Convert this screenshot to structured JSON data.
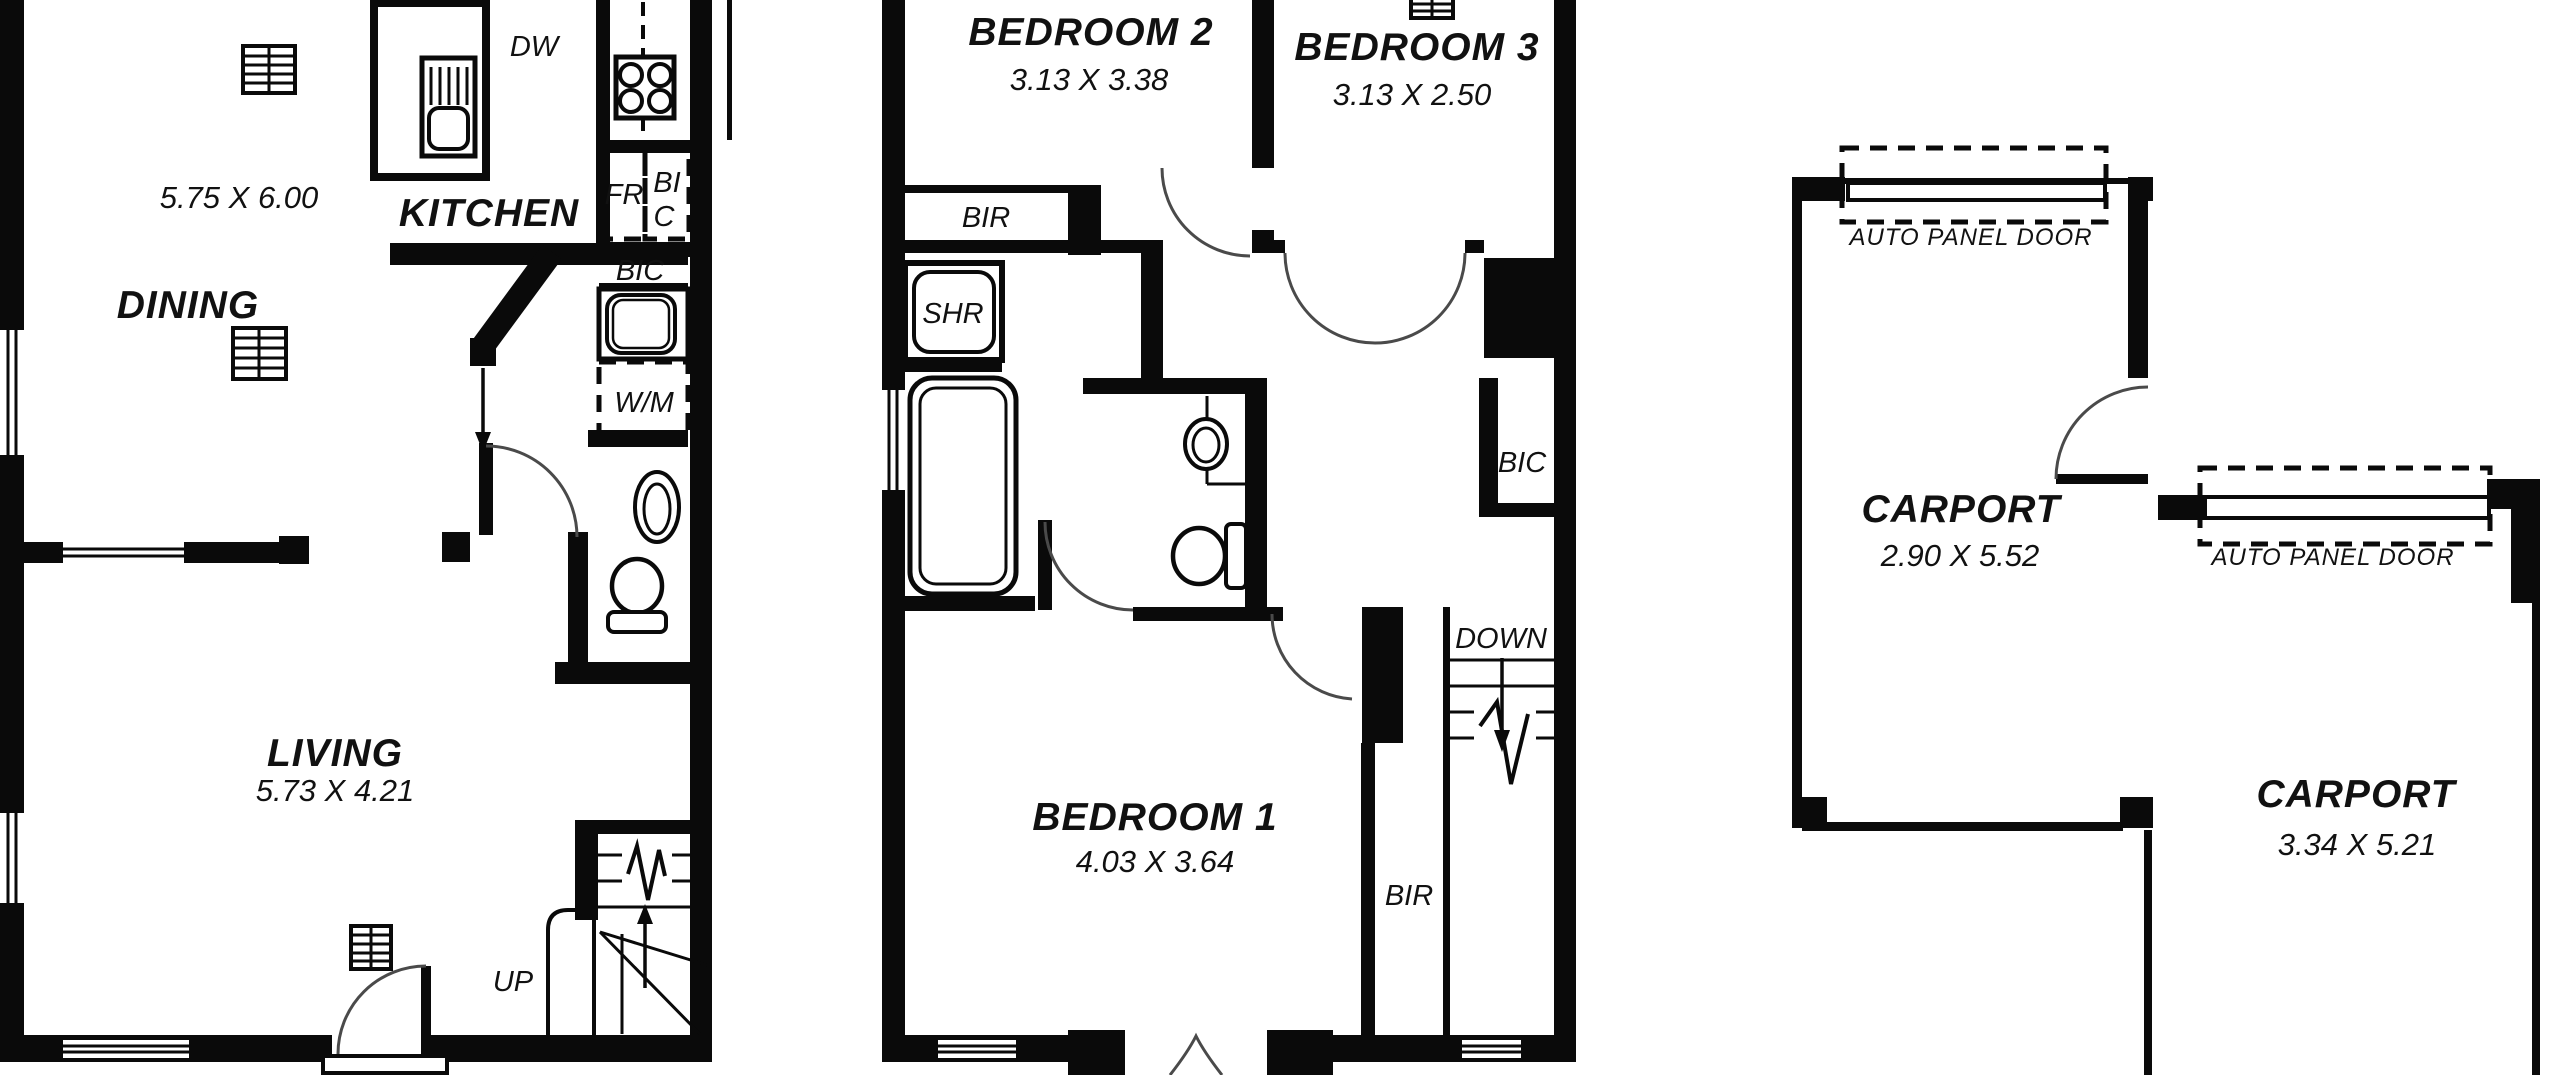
{
  "page": {
    "background": "#ffffff",
    "wall_color": "#0a0a0a",
    "line_color": "#4a4a4a"
  },
  "ground_floor": {
    "area_dims": "5.75 X 6.00",
    "kitchen_label": "KITCHEN",
    "dining_label": "DINING",
    "living_label": "LIVING",
    "living_dims": "5.73 X 4.21",
    "dishwasher_label": "DW",
    "fridge_label": "FR",
    "cupboard_stack_line1": "BI",
    "cupboard_stack_line2": "C",
    "cupboard_label": "BIC",
    "washing_machine_label": "W/M",
    "stairs_label": "UP"
  },
  "first_floor": {
    "bedroom2_label": "BEDROOM 2",
    "bedroom2_dims": "3.13 X 3.38",
    "bedroom3_label": "BEDROOM 3",
    "bedroom3_dims": "3.13 X 2.50",
    "bedroom1_label": "BEDROOM 1",
    "bedroom1_dims": "4.03 X 3.64",
    "robe2_label": "BIR",
    "shower_label": "SHR",
    "cupboard_label": "BIC",
    "stairs_label": "DOWN",
    "robe1_label": "BIR"
  },
  "carports": {
    "carport1_label": "CARPORT",
    "carport1_dims": "2.90 X 5.52",
    "carport1_door_label": "AUTO PANEL DOOR",
    "carport2_label": "CARPORT",
    "carport2_dims": "3.34 X 5.21",
    "carport2_door_label": "AUTO PANEL DOOR"
  }
}
